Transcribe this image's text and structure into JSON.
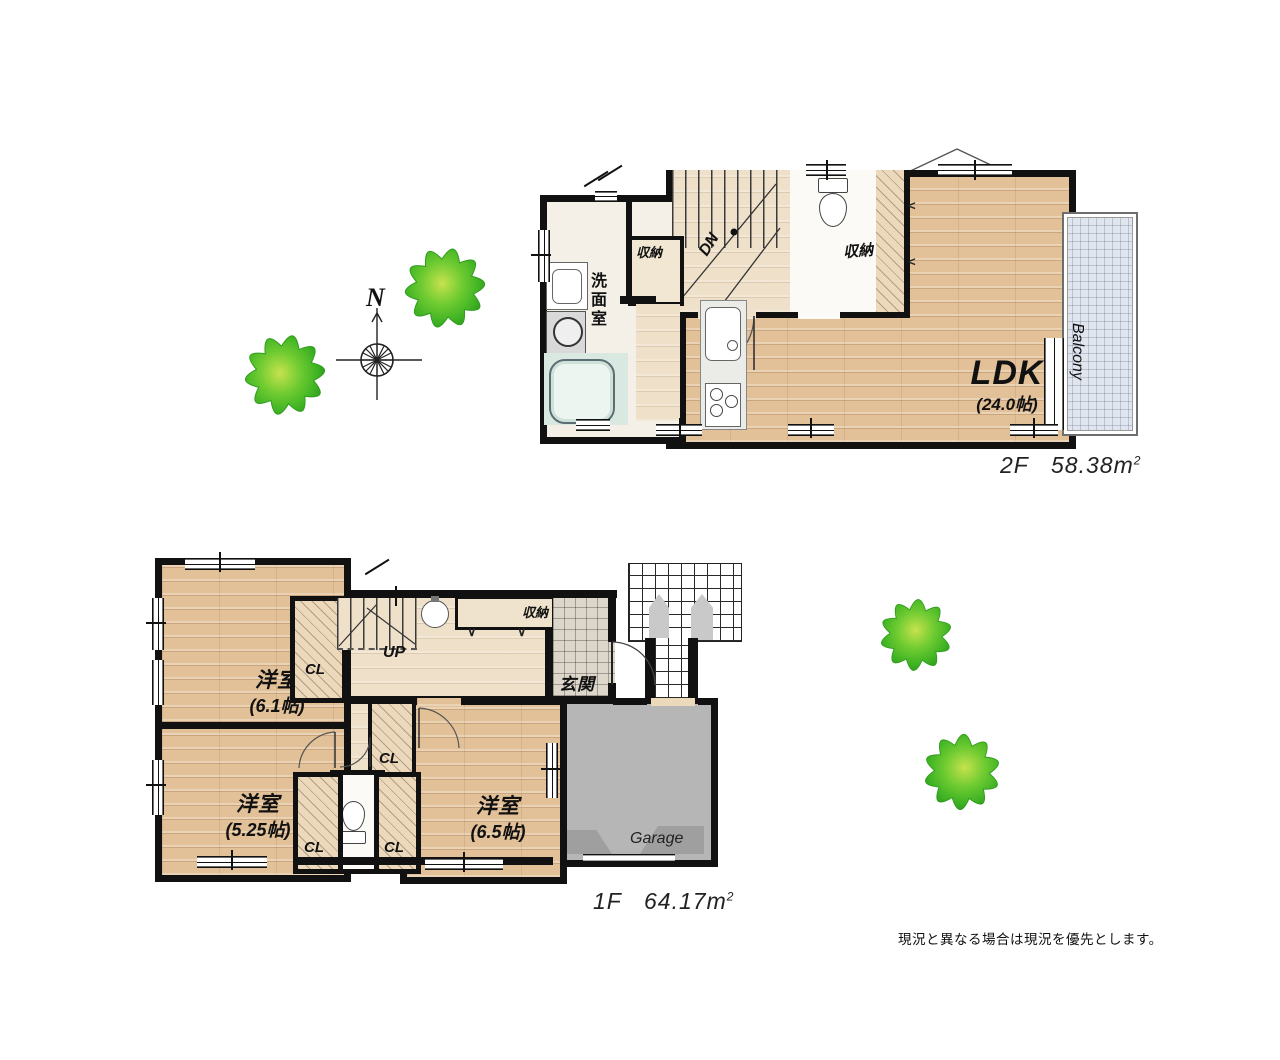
{
  "floor2": {
    "labels": {
      "ldk": "LDK",
      "ldk_size": "(24.0帖)",
      "balcony": "Balcony",
      "washroom": "洗面室",
      "storage_left": "収納",
      "storage_right": "収納",
      "stairs": "DN"
    },
    "area": {
      "floor": "2F",
      "value": "58.38",
      "unit": "m",
      "sup": "2"
    }
  },
  "floor1": {
    "labels": {
      "room_nw": "洋室",
      "room_nw_size": "(6.1帖)",
      "room_sw": "洋室",
      "room_sw_size": "(5.25帖)",
      "room_se": "洋室",
      "room_se_size": "(6.5帖)",
      "entrance": "玄関",
      "garage": "Garage",
      "storage": "収納",
      "stairs": "UP",
      "closet1": "CL",
      "closet2": "CL",
      "closet3": "CL",
      "closet4": "CL"
    },
    "area": {
      "floor": "1F",
      "value": "64.17",
      "unit": "m",
      "sup": "2"
    }
  },
  "compass": {
    "north": "N"
  },
  "note": "現況と異なる場合は現況を優先とします。",
  "colors": {
    "wall": "#111111",
    "wood_floor": "#e2c098",
    "hall_floor": "#efe1c9",
    "bath": "#d9e9e1",
    "balcony": "#e1e6ee",
    "garage": "#b6b6b6",
    "tree_edge": "#2f9c1d",
    "tree_mid": "#58c32b",
    "tree_center": "#c6e24e"
  }
}
